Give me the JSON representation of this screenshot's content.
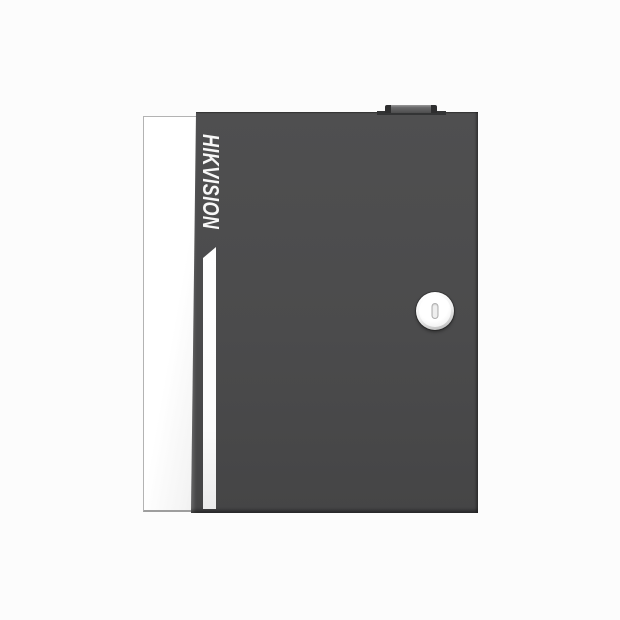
{
  "image": {
    "kind": "product-photo",
    "background_color": "#fcfcfc"
  },
  "device": {
    "brand_label": "HIKVISION",
    "description": "Dark gray wall-mount metal enclosure (access controller cabinet), front view, with white left side face, vertical white accent stripe, circular keyhole cam lock and a small tab on the top edge",
    "colors": {
      "door": "#4a4a4b",
      "door_edge": "#38383a",
      "side_panel": "#ffffff",
      "accent_stripe": "#ffffff",
      "logo_text": "#f8f8f8",
      "lock_face": "#f5f5f5",
      "keyslot_outline": "#aeaeae",
      "top_tab": "#4d4d4e"
    }
  }
}
